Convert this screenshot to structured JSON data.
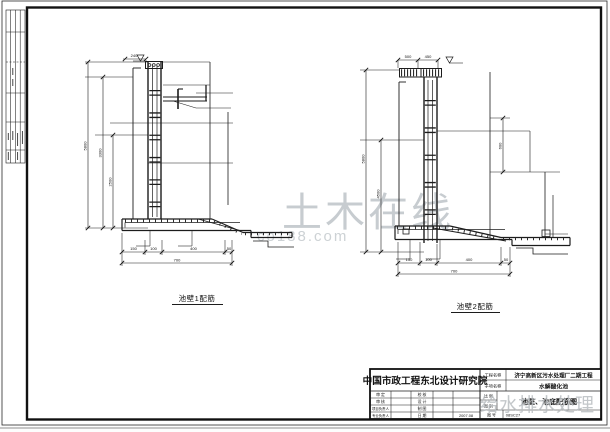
{
  "watermark": {
    "site": "土木在线",
    "url": "co188.com",
    "bottom": "给水排水处理"
  },
  "details": [
    {
      "label": "池壁1配筋",
      "dims": {
        "top": "240",
        "left": [
          "5800",
          "3300",
          "2500"
        ],
        "bottom": [
          "150",
          "100",
          "400",
          "50"
        ],
        "bottom_total": "700"
      }
    },
    {
      "label": "池壁2配筋",
      "dims": {
        "top": [
          "500",
          "450"
        ],
        "left": [
          "5800",
          "4500"
        ],
        "right": "600",
        "bottom": [
          "150",
          "100",
          "400",
          "50"
        ],
        "bottom_total": "700"
      }
    }
  ],
  "title_block": {
    "company": "中国市政工程东北设计研究院",
    "signoff": {
      "left": [
        {
          "label": "审 定",
          "value": ""
        },
        {
          "label": "审 核",
          "value": ""
        },
        {
          "label": "项目负责人",
          "value": ""
        },
        {
          "label": "专业负责人",
          "value": ""
        }
      ],
      "right": [
        {
          "label": "校 核",
          "value": ""
        },
        {
          "label": "设 计",
          "value": ""
        },
        {
          "label": "制 图",
          "value": ""
        },
        {
          "label": "日 期",
          "value": "2007.08"
        }
      ]
    },
    "project_label": "工程名称",
    "project_name": "济宁高新区污水处理厂二期工程",
    "subproject_label": "子项名称",
    "subproject_name": "水解酸化池",
    "scale_label": "比 例",
    "type_label": "图 别",
    "type_value": "",
    "drawing_name": "池壁、池底配筋图",
    "no_label": "图 号",
    "sheet_no": "08SC27"
  }
}
